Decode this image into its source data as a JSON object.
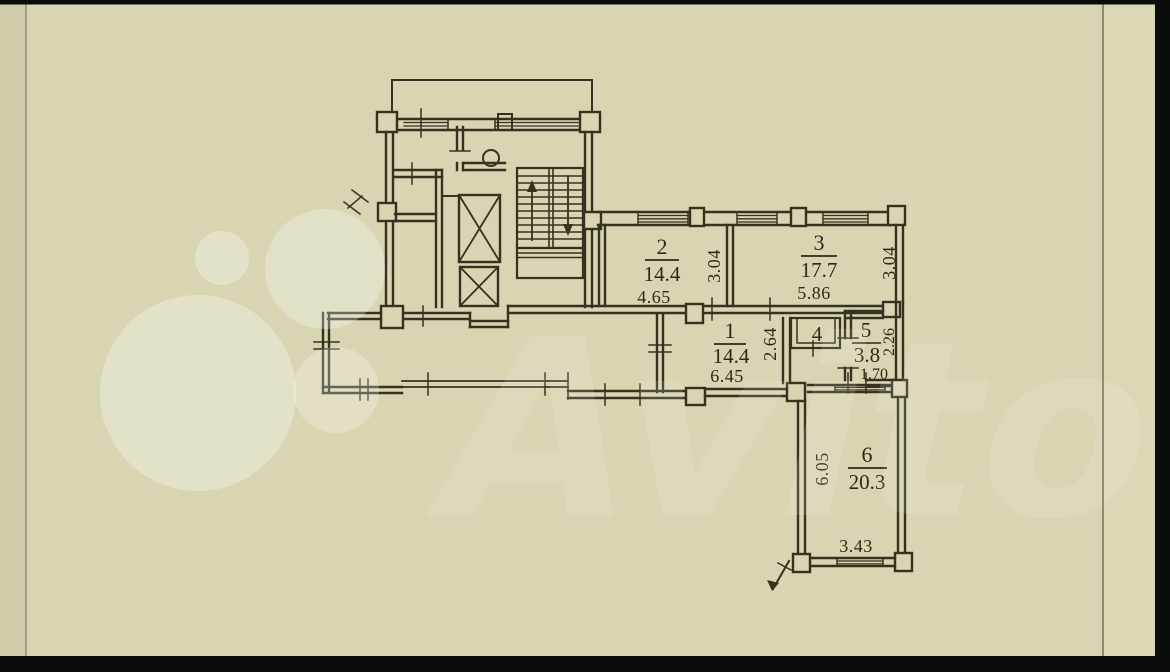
{
  "watermark": {
    "brand": "Avito"
  },
  "rooms": {
    "r1": {
      "number": "1",
      "area": "14.4",
      "width": "6.45",
      "depth": "2.64"
    },
    "r2": {
      "number": "2",
      "area": "14.4",
      "width": "4.65",
      "depth": "3.04"
    },
    "r3": {
      "number": "3",
      "area": "17.7",
      "width": "5.86",
      "depth": "3.04"
    },
    "r4": {
      "number": "4"
    },
    "r5": {
      "number": "5",
      "area": "3.8",
      "width": "1.70",
      "depth": "2.26"
    },
    "r6": {
      "number": "6",
      "area": "20.3",
      "width": "3.43",
      "depth": "6.05"
    }
  },
  "colors": {
    "paper": "#d8d5b2",
    "ink": "#35321f",
    "watermark": "#ffffff",
    "photo_border": "#0b0b09"
  }
}
